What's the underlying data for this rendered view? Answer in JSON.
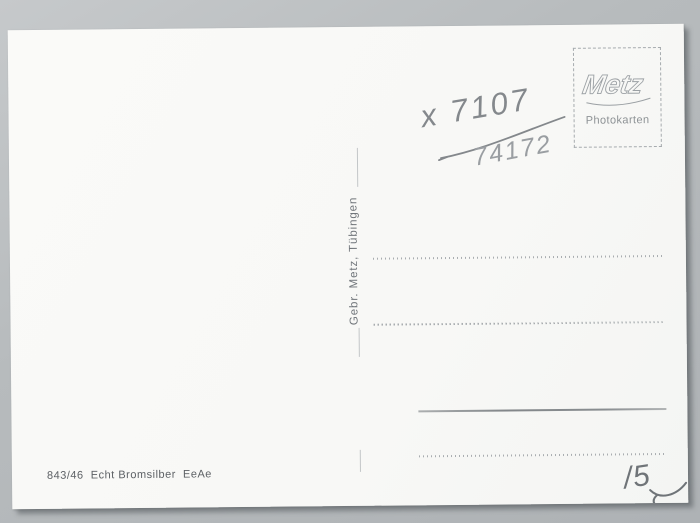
{
  "card": {
    "stamp_box": {
      "brand": "Metz",
      "subtitle": "Photokarten"
    },
    "handwriting": {
      "number_top": "x 7107",
      "number_bottom": "74172",
      "corner_mark": "/5"
    },
    "publisher_vertical": "Gebr. Metz, Tübingen",
    "print_code": "843/46  Echt Bromsilber  EeAe"
  },
  "colors": {
    "scan_background": "#b4b8bb",
    "card_paper": "#f8f8f6",
    "printed_gray": "#9aa0a3",
    "pencil_gray": "#84888c",
    "imprint_text": "#5d6165"
  }
}
